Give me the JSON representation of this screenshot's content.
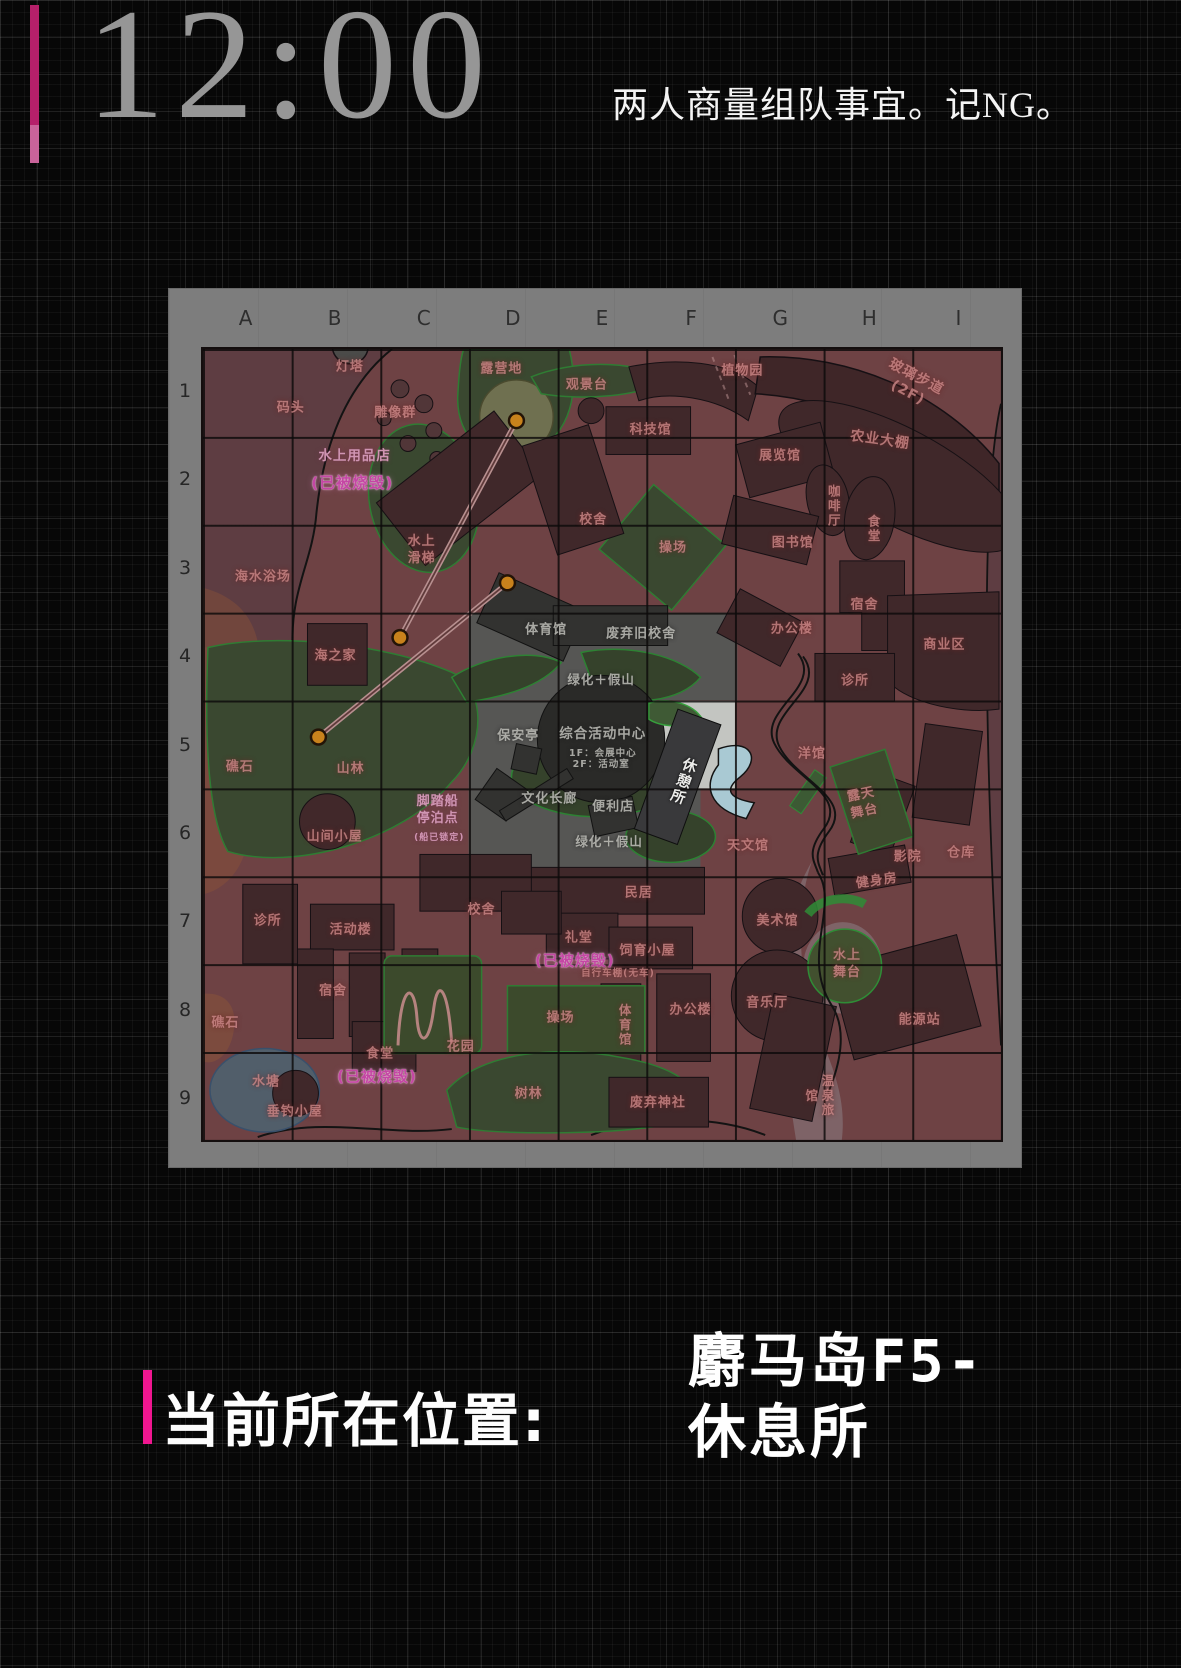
{
  "header": {
    "time": "12:00",
    "note": "两人商量组队事宜。记NG。"
  },
  "footer": {
    "label": "当前所在位置:",
    "line1": "麝马岛F5-",
    "line2": "休息所"
  },
  "colors": {
    "accent_magenta": "#f01690",
    "accent_bar_top": "#b5206a",
    "burnt_label": "#c447a4",
    "map_land": "#6e4244",
    "current_area_gray": "#565654",
    "highlight_cell": "#c3c5c1",
    "zipline_dot": "#c8821c",
    "green_zone": "#3a4830"
  },
  "map": {
    "columns": [
      "A",
      "B",
      "C",
      "D",
      "E",
      "F",
      "G",
      "H",
      "I"
    ],
    "rows": [
      "1",
      "2",
      "3",
      "4",
      "5",
      "6",
      "7",
      "8",
      "9"
    ],
    "current_cell": "F5",
    "zipline": {
      "dots": [
        [
          315,
          72
        ],
        [
          306,
          235
        ],
        [
          198,
          290
        ],
        [
          116,
          390
        ]
      ],
      "lines": [
        [
          0,
          2
        ],
        [
          1,
          3
        ]
      ]
    },
    "labels": [
      {
        "t": "灯塔",
        "x": 18.4,
        "y": 2.4
      },
      {
        "t": "码头",
        "x": 11.0,
        "y": 7.6
      },
      {
        "t": "雕像群",
        "x": 24.1,
        "y": 8.2
      },
      {
        "t": "露营地",
        "x": 37.4,
        "y": 2.6
      },
      {
        "t": "观景台",
        "x": 48.1,
        "y": 4.7
      },
      {
        "t": "植物园",
        "x": 67.6,
        "y": 2.9
      },
      {
        "t": "玻璃步道(2F)",
        "x": 88.8,
        "y": 4.5,
        "r": 28,
        "s": 14
      },
      {
        "t": "农业大棚",
        "x": 84.8,
        "y": 11.5,
        "r": 8,
        "s": 14
      },
      {
        "t": "水上用品店",
        "x": 19.0,
        "y": 13.6,
        "c": "p",
        "s": 13.5
      },
      {
        "t": "(已被烧毁)",
        "x": 18.7,
        "y": 17.0,
        "c": "m",
        "s": 15.5
      },
      {
        "t": "科技馆",
        "x": 56.1,
        "y": 10.4
      },
      {
        "t": "展览馆",
        "x": 72.3,
        "y": 13.7
      },
      {
        "t": "咖啡厅",
        "x": 78.9,
        "y": 19.9,
        "v": 1,
        "s": 12.5
      },
      {
        "t": "食堂",
        "x": 83.9,
        "y": 22.8,
        "v": 1,
        "s": 12.5
      },
      {
        "t": "校舍",
        "x": 48.9,
        "y": 21.8
      },
      {
        "t": "操场",
        "x": 58.9,
        "y": 25.3
      },
      {
        "t": "图书馆",
        "x": 73.9,
        "y": 24.7
      },
      {
        "t": "海水浴场",
        "x": 7.5,
        "y": 28.9
      },
      {
        "t": "水上\n滑梯",
        "x": 27.4,
        "y": 25.5
      },
      {
        "t": "宿舍",
        "x": 82.9,
        "y": 32.5
      },
      {
        "t": "海之家",
        "x": 16.6,
        "y": 39.0
      },
      {
        "t": "体育馆",
        "x": 43.0,
        "y": 35.6,
        "c": "g"
      },
      {
        "t": "废弃旧校舍",
        "x": 54.9,
        "y": 36.1,
        "c": "g"
      },
      {
        "t": "办公楼",
        "x": 73.8,
        "y": 35.5
      },
      {
        "t": "绿化＋假山",
        "x": 49.9,
        "y": 41.9,
        "c": "g",
        "s": 12.5
      },
      {
        "t": "诊所",
        "x": 81.7,
        "y": 42.1
      },
      {
        "t": "商业区",
        "x": 92.9,
        "y": 37.6
      },
      {
        "t": "礁石",
        "x": 4.6,
        "y": 53.0
      },
      {
        "t": "山林",
        "x": 18.5,
        "y": 53.2
      },
      {
        "t": "保安亭",
        "x": 39.5,
        "y": 49.1,
        "c": "g"
      },
      {
        "t": "综合活动中心",
        "x": 50.1,
        "y": 48.8,
        "c": "g",
        "s": 13.5
      },
      {
        "t": "1F：会展中心",
        "x": 50.1,
        "y": 51.2,
        "c": "g",
        "s": 9.5
      },
      {
        "t": "2F：活动室",
        "x": 49.9,
        "y": 52.6,
        "c": "g",
        "s": 9.5
      },
      {
        "t": "休憩所",
        "x": 60.0,
        "y": 54.6,
        "c": "w",
        "v": 1,
        "r": 20,
        "s": 14.5
      },
      {
        "t": "洋馆",
        "x": 76.3,
        "y": 51.3
      },
      {
        "t": "露天\n舞台",
        "x": 82.7,
        "y": 57.5,
        "r": -12
      },
      {
        "t": "文化长廊",
        "x": 43.4,
        "y": 57.0,
        "c": "g"
      },
      {
        "t": "便利店",
        "x": 51.4,
        "y": 58.0,
        "c": "g"
      },
      {
        "t": "脚踏船\n停泊点",
        "x": 29.4,
        "y": 58.4,
        "c": "p"
      },
      {
        "t": "(船已锁定)",
        "x": 29.6,
        "y": 62.0,
        "c": "p",
        "s": 9
      },
      {
        "t": "山间小屋",
        "x": 16.5,
        "y": 61.8
      },
      {
        "t": "绿化＋假山",
        "x": 50.9,
        "y": 62.3,
        "c": "g",
        "s": 12.5
      },
      {
        "t": "天文馆",
        "x": 68.3,
        "y": 63.0
      },
      {
        "t": "影院",
        "x": 88.3,
        "y": 64.3
      },
      {
        "t": "仓库",
        "x": 95.0,
        "y": 63.9
      },
      {
        "t": "健身房",
        "x": 84.5,
        "y": 67.4,
        "r": -8
      },
      {
        "t": "民居",
        "x": 54.6,
        "y": 68.9
      },
      {
        "t": "美术馆",
        "x": 72.0,
        "y": 72.5
      },
      {
        "t": "诊所",
        "x": 8.1,
        "y": 72.5
      },
      {
        "t": "活动楼",
        "x": 18.5,
        "y": 73.6
      },
      {
        "t": "校舍",
        "x": 34.9,
        "y": 71.1
      },
      {
        "t": "礼堂",
        "x": 47.1,
        "y": 74.6
      },
      {
        "t": "(已被烧毁)",
        "x": 46.6,
        "y": 77.4,
        "c": "m",
        "s": 15
      },
      {
        "t": "饲育小屋",
        "x": 55.7,
        "y": 76.2
      },
      {
        "t": "自行车棚(无车)",
        "x": 52.0,
        "y": 79.0,
        "s": 9.5
      },
      {
        "t": "水上\n舞台",
        "x": 80.7,
        "y": 77.9
      },
      {
        "t": "宿舍",
        "x": 16.3,
        "y": 81.3
      },
      {
        "t": "礁石",
        "x": 2.8,
        "y": 85.3
      },
      {
        "t": "花园",
        "x": 32.3,
        "y": 88.4
      },
      {
        "t": "操场",
        "x": 44.8,
        "y": 84.7
      },
      {
        "t": "体育馆",
        "x": 52.7,
        "y": 85.5,
        "v": 1,
        "s": 12.5
      },
      {
        "t": "办公楼",
        "x": 61.1,
        "y": 83.7
      },
      {
        "t": "音乐厅",
        "x": 70.7,
        "y": 82.8
      },
      {
        "t": "能源站",
        "x": 89.8,
        "y": 85.0
      },
      {
        "t": "食堂",
        "x": 22.2,
        "y": 89.3
      },
      {
        "t": "(已被烧毁)",
        "x": 21.8,
        "y": 92.0,
        "c": "m",
        "s": 15
      },
      {
        "t": "水塘",
        "x": 7.9,
        "y": 92.8
      },
      {
        "t": "垂钓小屋",
        "x": 11.5,
        "y": 96.6
      },
      {
        "t": "树林",
        "x": 40.8,
        "y": 94.3
      },
      {
        "t": "废弃神社",
        "x": 57.0,
        "y": 95.4
      },
      {
        "t": "温泉旅馆",
        "x": 77.1,
        "y": 94.5,
        "v": 1,
        "s": 12.5
      }
    ]
  }
}
